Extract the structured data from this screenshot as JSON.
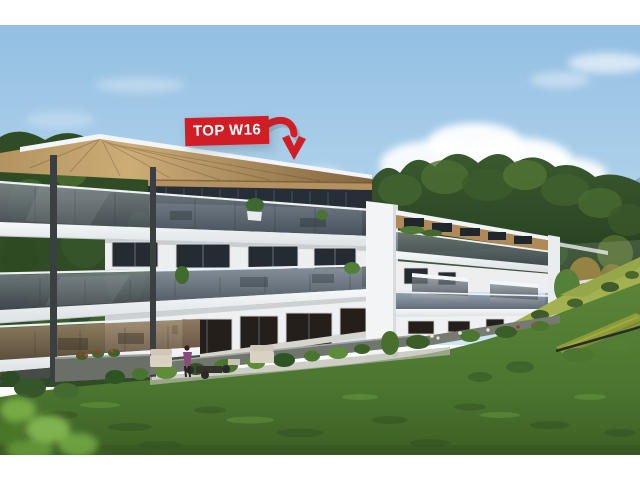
{
  "annotation": {
    "label": "TOP W16",
    "badge_color": "#d11d25",
    "label_color": "#ffffff",
    "arrow_color": "#d11d25"
  },
  "scene": {
    "colors": {
      "sky_top": "#93bfe2",
      "sky_bottom": "#cfe6f5",
      "cloud": "#ffffff",
      "mountain": "#8fa7bb",
      "forest_dark": "#22391d",
      "forest_mid": "#3a5a2e",
      "lawn_light": "#5b8438",
      "lawn_dark": "#426a29",
      "slope_grass": "#a3b150",
      "green_roof": "#8c9a3a",
      "roof_wood": "#b5915e",
      "penthouse_wood": "#ad8a58",
      "facade_white": "#f2f4f6",
      "balustrade_glass": "#5a646e",
      "balustrade_bronze": "#8a7560",
      "window_glass": "#242b31",
      "steel_column": "#3a3f42",
      "letterbox": "#ffffff"
    }
  }
}
